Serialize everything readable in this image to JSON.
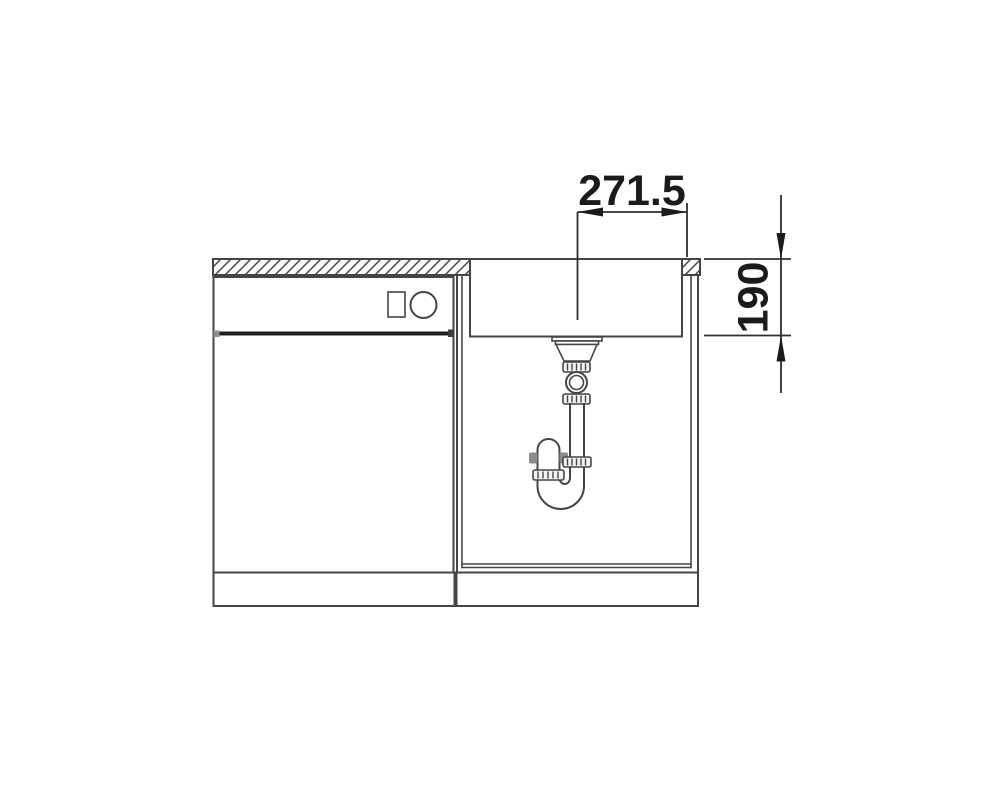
{
  "diagram": {
    "dimension_labels": {
      "horizontal": "271.5",
      "vertical": "190"
    },
    "colors": {
      "background": "#ffffff",
      "line": "#454545",
      "dark": "#1f1f1f",
      "dimension": "#2f2f2f",
      "text": "#1b1b1b"
    }
  }
}
